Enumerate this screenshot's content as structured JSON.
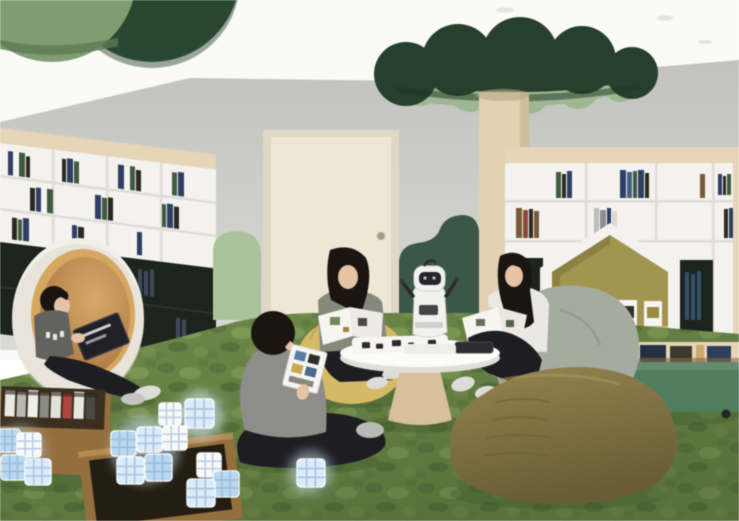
{
  "meta": {
    "type": "interior-architectural-rendering",
    "description": "Rendering of a children's smart library reading room: three girls read books on bean bags around a round white table holding a small white companion robot and a tablet; a boy sits cross-legged on mossy green carpet holding a block-building card; another boy reads inside a white circular pod chair; wooden bins hold glowing smart cubes; white bookshelves with dark lower cabinets and a house-shaped nook line the walls; a cream door sits between sage and forest-green wavy wall panels; green cloud canopies and discs hang from the white ceiling, one atop a wooden tree column."
  },
  "palette": {
    "ceiling": "#fafaf7",
    "wall": "#c8c9c5",
    "disc_light_green": "#7f9d70",
    "disc_dark_green": "#2f4f38",
    "canopy_dark": "#26402c",
    "canopy_light": "#9cb791",
    "wood_column": "#e4d1b0",
    "wood_trim": "#e7d5b5",
    "shelf_white": "#f3f2ee",
    "shelf_line": "#dedcd6",
    "cabinet_dark": "#1d231d",
    "door": "#ece4d0",
    "door_frame": "#dfd8c4",
    "knob": "#a59c86",
    "panel_sage": "#a9c399",
    "panel_forest": "#3a5747",
    "carpet": "#6f8a49",
    "carpet_dark": "#55703a",
    "carpet_light": "#8aa45c",
    "pod_shell": "#f2efe8",
    "pod_rim": "#d8a75e",
    "pod_inner": "#9e7138",
    "bean_yellow": "#d7b964",
    "bean_gray": "#a4aca0",
    "bean_olive": "#857544",
    "table_top": "#fbfbf8",
    "table_base": "#d9c09a",
    "robot_white": "#f1f1ef",
    "robot_dark": "#26262a",
    "cart_green": "#4e7d5d",
    "box_wood": "#946f3c",
    "cube_glow": "#d9ecfc",
    "cube_white": "#f6f9fb",
    "cube_blue": "#b7d7f2",
    "book_navy": "#2e3f66",
    "book_green": "#3f5a3e",
    "book_dark": "#2a2a22",
    "book_brown": "#7a5a36",
    "nook_olive": "#a3954d",
    "nook_olive_dark": "#8d8040",
    "skin": "#e6c4a4",
    "hair": "#1b1512",
    "shirt_gray": "#8d8d89",
    "shirt_sage": "#85887b",
    "shirt_white": "#e9e8e4",
    "pants_black": "#1e1e22",
    "shoe_white": "#dcdcd8",
    "paper": "#f6f5f2"
  },
  "objects": [
    "ceiling-disc-light-green",
    "ceiling-disc-dark-green",
    "tree-canopy",
    "tree-column",
    "left-bookshelf",
    "right-bookshelf",
    "house-nook",
    "door",
    "sage-wall-panel",
    "forest-wall-panel",
    "pod-chair",
    "reading-boy-in-pod",
    "round-table",
    "companion-robot",
    "robot-parts-tray",
    "tablet",
    "girl-reading-left",
    "girl-reading-right",
    "boy-on-floor",
    "yellow-bean-bag",
    "gray-bean-bag",
    "olive-bean-bag",
    "glowing-smart-cubes",
    "wooden-block-bins",
    "green-book-cart",
    "moss-carpet"
  ]
}
